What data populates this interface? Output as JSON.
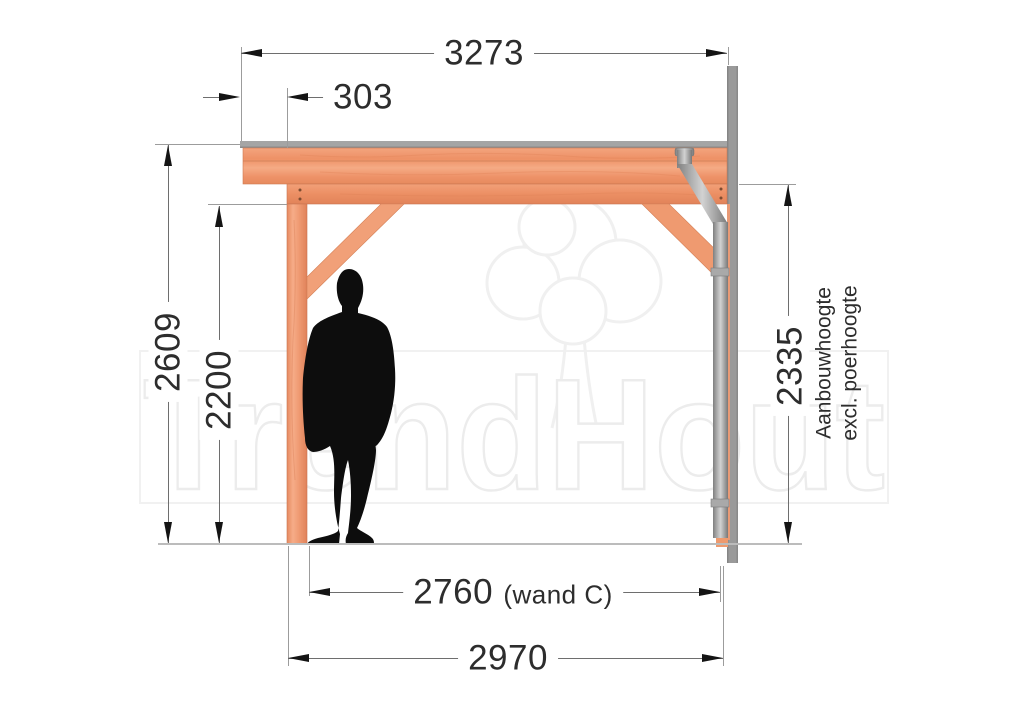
{
  "watermark": {
    "text": "TrendHout"
  },
  "dimensions": {
    "top_width": "3273",
    "overhang": "303",
    "left_height": "2609",
    "clear_height": "2200",
    "attach_height": "2335",
    "inner_width": "2760",
    "inner_width_note": "(wand C)",
    "bottom_width": "2970"
  },
  "labels": {
    "attach_note_line1": "Aanbouwhoogte",
    "attach_note_line2": "excl. poerhoogte"
  },
  "colors": {
    "wood": "#f09a72",
    "wood_dark": "#d97e55",
    "roof_panel": "#a3a3a3",
    "wall": "#9a9a9a",
    "pipe": "#bdbdbd",
    "silhouette": "#0d0d0d",
    "dimension_line": "#6e6e6e",
    "text": "#2d2d2d",
    "watermark_stroke": "#ededed"
  }
}
